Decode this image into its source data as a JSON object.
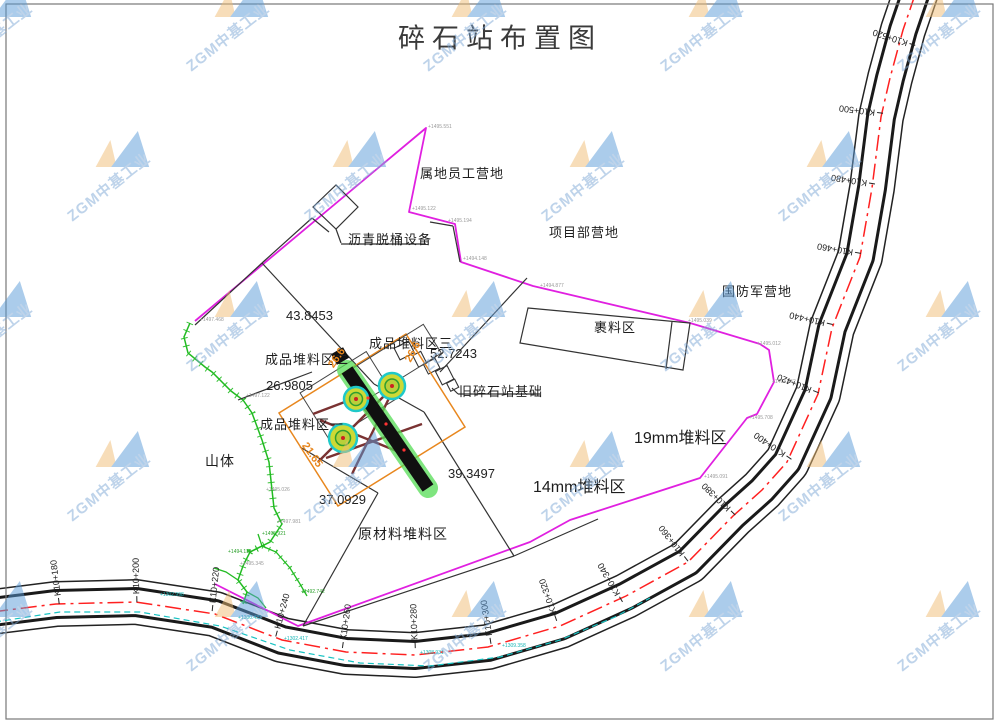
{
  "title": "碎石站布置图",
  "watermark": {
    "text": "ZGM中基工业"
  },
  "areas": [
    {
      "id": "local-staff-camp",
      "label": "属地员工营地"
    },
    {
      "id": "asphalt-drum-unit",
      "label": "沥青脱桶设备"
    },
    {
      "id": "project-dept-camp",
      "label": "项目部营地"
    },
    {
      "id": "defense-army-camp",
      "label": "国防军营地"
    },
    {
      "id": "wrap-material-area",
      "label": "裹料区"
    },
    {
      "id": "product-pile-3",
      "label": "成品堆料区三"
    },
    {
      "id": "product-pile-2",
      "label": "成品堆料区二"
    },
    {
      "id": "product-pile-1",
      "label": "成品堆料区一"
    },
    {
      "id": "old-crusher-base",
      "label": "旧碎石站基础"
    },
    {
      "id": "pile-19mm",
      "label": "19mm堆料区"
    },
    {
      "id": "pile-14mm",
      "label": "14mm堆料区"
    },
    {
      "id": "raw-material-pile",
      "label": "原材料堆料区"
    },
    {
      "id": "mountain",
      "label": "山体"
    }
  ],
  "dimensions": [
    {
      "value": "43.8453"
    },
    {
      "value": "52.7243"
    },
    {
      "value": "26.9805"
    },
    {
      "value": "39.3497"
    },
    {
      "value": "37.0929"
    }
  ],
  "orange_dimensions": [
    {
      "value": "26.6"
    },
    {
      "value": "26.6"
    },
    {
      "value": "21.65"
    }
  ],
  "stations": [
    {
      "label": "K10+180"
    },
    {
      "label": "K10+200"
    },
    {
      "label": "K10+220"
    },
    {
      "label": "K10+240"
    },
    {
      "label": "K10+260"
    },
    {
      "label": "K10+280"
    },
    {
      "label": "K10+300"
    },
    {
      "label": "K10+320"
    },
    {
      "label": "K10+340"
    },
    {
      "label": "K10+360"
    },
    {
      "label": "K10+380"
    },
    {
      "label": "K10+400"
    },
    {
      "label": "K10+420"
    },
    {
      "label": "K10+440"
    },
    {
      "label": "K10+460"
    },
    {
      "label": "K10+480"
    },
    {
      "label": "K10+500"
    },
    {
      "label": "K10+520"
    }
  ],
  "elevations": {
    "gray": [
      {
        "value": "+1495.122"
      },
      {
        "value": "+1495.194"
      },
      {
        "value": "+1494.148"
      },
      {
        "value": "+1494.877"
      },
      {
        "value": "+1495.039"
      },
      {
        "value": "+1495.012"
      },
      {
        "value": "+1494.652"
      },
      {
        "value": "+1495.708"
      },
      {
        "value": "+1495.091"
      },
      {
        "value": "+1497.468"
      },
      {
        "value": "+1495.551"
      },
      {
        "value": "+1497.122"
      },
      {
        "value": "+1495.026"
      },
      {
        "value": "+1497.981"
      },
      {
        "value": "+1495.345"
      }
    ],
    "green": [
      {
        "value": "+1495.921"
      },
      {
        "value": "+1492.742"
      },
      {
        "value": "+1494.118"
      }
    ],
    "cyan": [
      {
        "value": "+1302.998"
      },
      {
        "value": "+1300.433"
      },
      {
        "value": "+1302.417"
      },
      {
        "value": "+1308.931"
      },
      {
        "value": "+1309.358"
      }
    ]
  },
  "colors": {
    "site_boundary": "#e020e0",
    "slope_line": "#22bb22",
    "ditch_line": "#17c3c3",
    "road_centerline": "#ff2020",
    "pad_outline": "#e8871e",
    "machine_highlight": "#55dd55",
    "conveyor": "#7a3232"
  }
}
